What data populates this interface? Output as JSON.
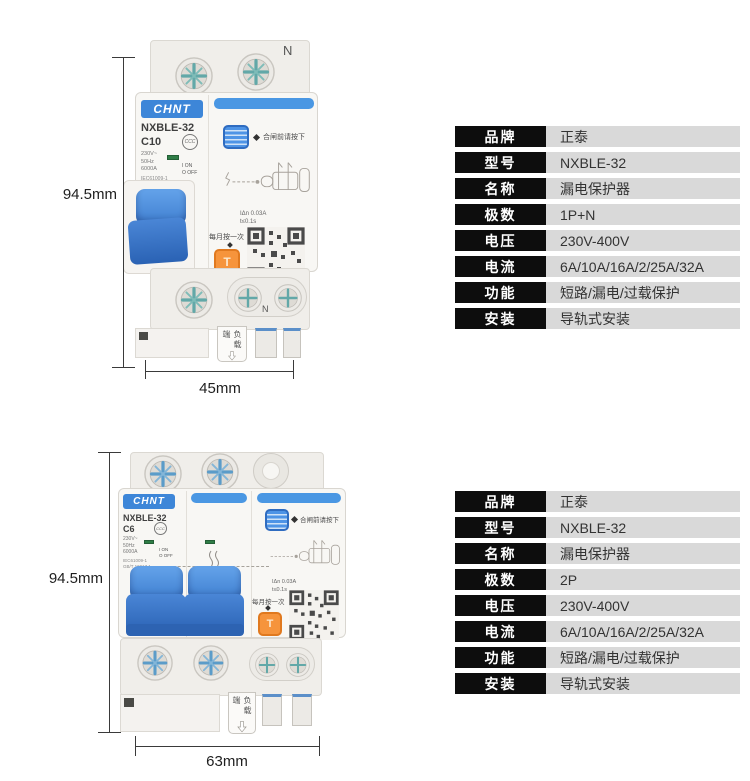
{
  "colors": {
    "brand_blue": "#3d86d8",
    "accent_blue_bar": "#4a97e3",
    "lever_blue": "#3f7fd0",
    "test_button_orange": "#f6943c",
    "table_label_bg": "#0d0d0d",
    "table_value_bg": "#d9d9d9",
    "page_bg": "#ffffff"
  },
  "breaker1": {
    "brand_logo": "CHNT",
    "model": "NXBLE-32",
    "curve": "C10",
    "voltage": "230V~",
    "frequency": "50Hz",
    "breaking_capacity": "6000A",
    "standard_1": "IEC61009-1",
    "standard_2": "GB/T 16917.1",
    "on_marking": "I ON",
    "off_marking": "O OFF",
    "cert_mark": "CCC",
    "neutral_top": "N",
    "neutral_bottom": "N",
    "press_note": "合闸前请按下",
    "residual_current": "IΔn 0.03A",
    "trip_time": "t≤0.1s",
    "monthly_test_note": "每月按一次",
    "test_button": "T",
    "load_side_label": "负载端",
    "dim_height": "94.5mm",
    "dim_width": "45mm"
  },
  "breaker2": {
    "brand_logo": "CHNT",
    "model": "NXBLE-32",
    "curve": "C6",
    "voltage": "230V~",
    "frequency": "50Hz",
    "breaking_capacity": "6000A",
    "standard_1": "IEC61009-1",
    "standard_2": "GB/T 16917.1",
    "on_marking": "I ON",
    "off_marking": "O OFF",
    "cert_mark": "CCC",
    "press_note": "合闸前请按下",
    "residual_current": "IΔn 0.03A",
    "trip_time": "t≤0.1s",
    "monthly_test_note": "每月按一次",
    "test_button": "T",
    "load_side_label": "负载端",
    "dim_height": "94.5mm",
    "dim_width": "63mm"
  },
  "table1": {
    "rows": [
      {
        "label": "品牌",
        "value": "正泰"
      },
      {
        "label": "型号",
        "value": "NXBLE-32"
      },
      {
        "label": "名称",
        "value": "漏电保护器"
      },
      {
        "label": "极数",
        "value": "1P+N"
      },
      {
        "label": "电压",
        "value": "230V-400V"
      },
      {
        "label": "电流",
        "value": "6A/10A/16A/2/25A/32A"
      },
      {
        "label": "功能",
        "value": "短路/漏电/过载保护"
      },
      {
        "label": "安装",
        "value": "导轨式安装"
      }
    ]
  },
  "table2": {
    "rows": [
      {
        "label": "品牌",
        "value": "正泰"
      },
      {
        "label": "型号",
        "value": "NXBLE-32"
      },
      {
        "label": "名称",
        "value": "漏电保护器"
      },
      {
        "label": "极数",
        "value": "2P"
      },
      {
        "label": "电压",
        "value": "230V-400V"
      },
      {
        "label": "电流",
        "value": "6A/10A/16A/2/25A/32A"
      },
      {
        "label": "功能",
        "value": "短路/漏电/过载保护"
      },
      {
        "label": "安装",
        "value": "导轨式安装"
      }
    ]
  }
}
